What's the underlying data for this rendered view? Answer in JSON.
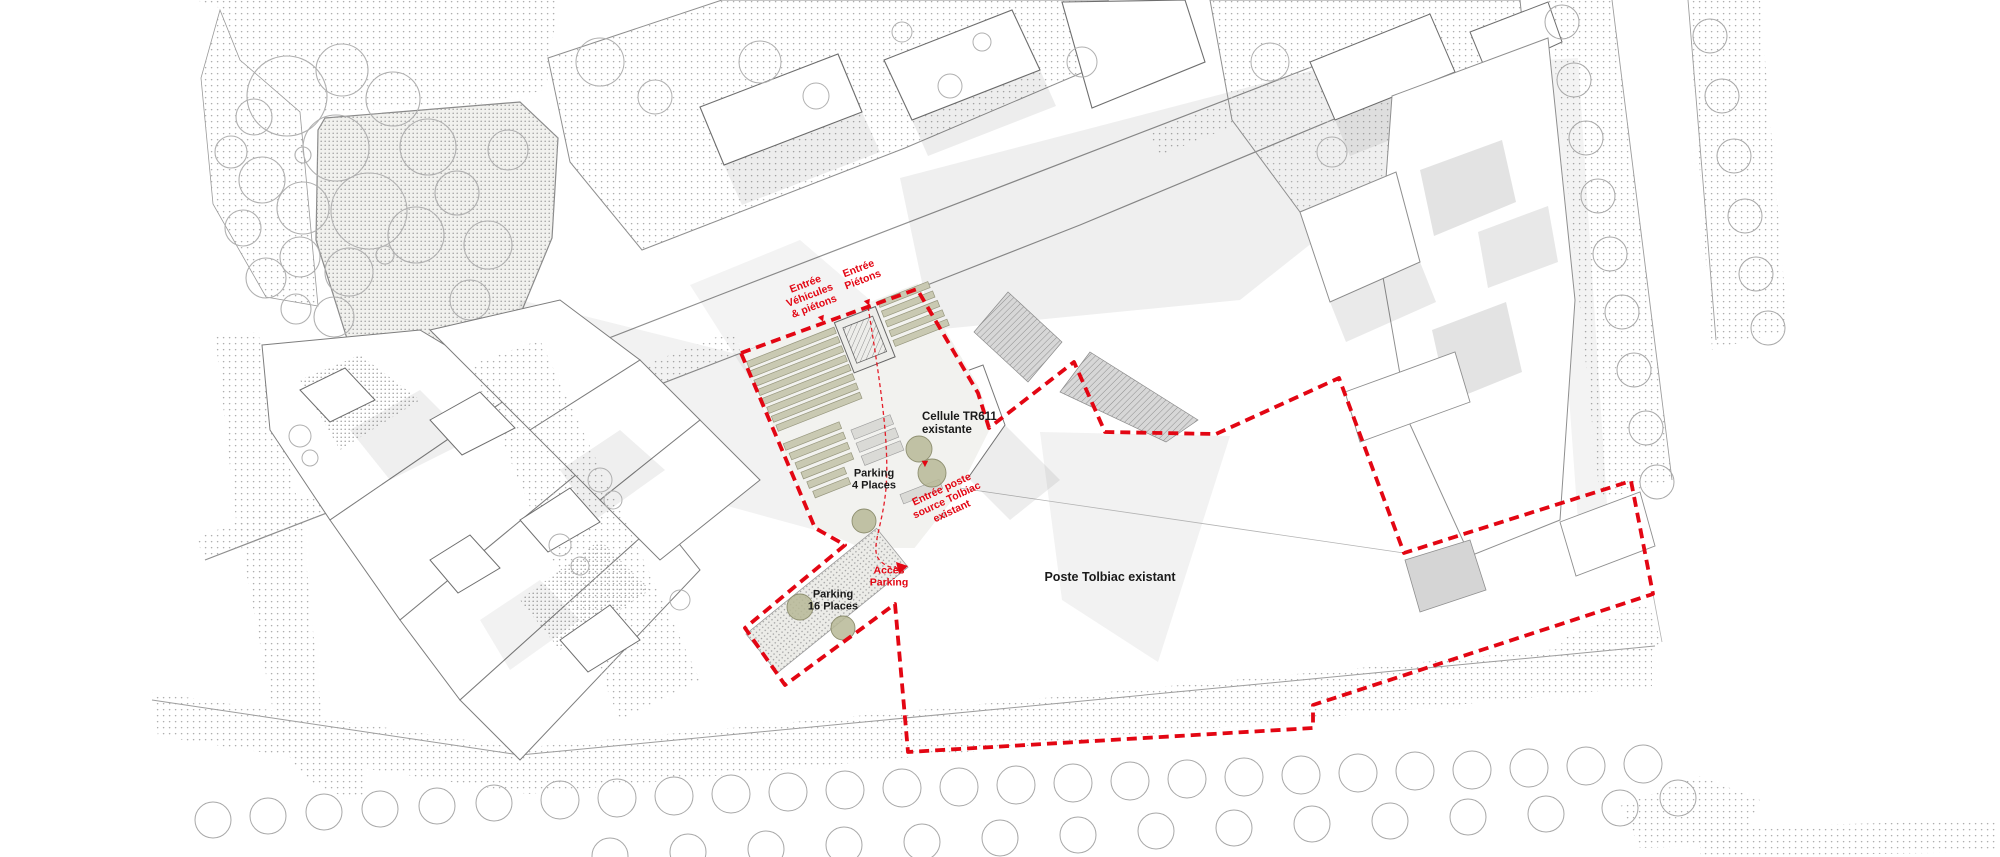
{
  "labels": {
    "entree_vehicules": "Entrée\nVéhicules\n& piétons",
    "entree_pietons": "Entrée\nPiétons",
    "cellule_tr611": "Cellule TR611\nexistante",
    "parking_4": "Parking\n4 Places",
    "entree_poste": "Entrée poste\nsource Tolbiac\nexistant",
    "acces_parking": "Accès\nParking",
    "parking_16": "Parking\n16 Places",
    "poste_tolbiac": "Poste Tolbiac existant"
  },
  "icons": {
    "arrow_down": "▼"
  },
  "colors": {
    "site_boundary_red": "#e30613",
    "roof_olive": "#c9c9b2",
    "tree_olive": "#b7b896",
    "building_outline": "#6e6e6e",
    "shadow_gray": "#d9d9d9",
    "stipple_gray": "#adadad"
  }
}
